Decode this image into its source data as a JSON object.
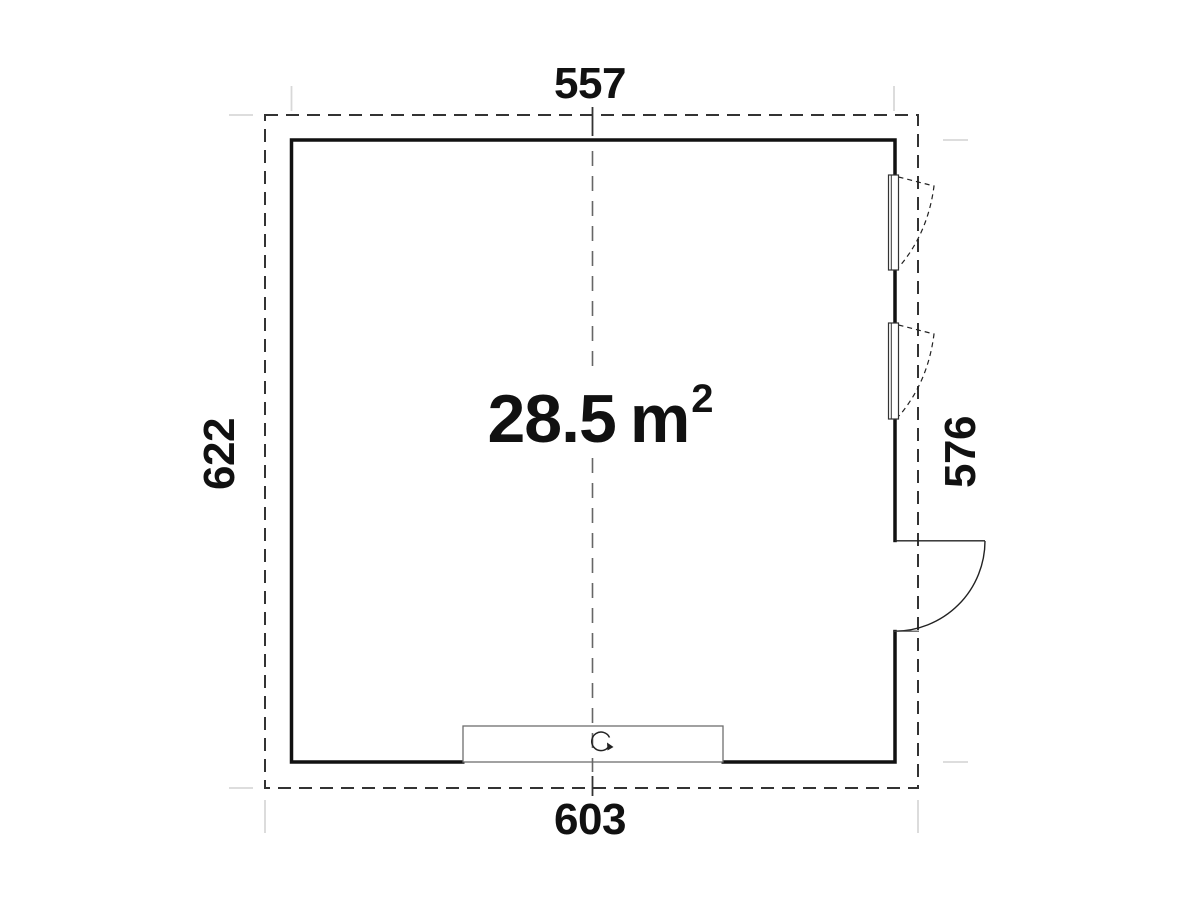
{
  "plan": {
    "dimensions": {
      "top": "557",
      "bottom": "603",
      "left": "622",
      "right": "576"
    },
    "area": {
      "value": "28.5",
      "unit": "m",
      "exponent": "2"
    },
    "icons": {
      "rotation_symbol": "rotation-arrow-icon"
    },
    "colors": {
      "background": "#ffffff",
      "wall": "#111111",
      "overhang_dash": "#333333",
      "centerline": "#666666",
      "detail_line": "#222222",
      "garage_outline": "#6e6e6e",
      "extension_line": "#d8d8d8",
      "text": "#111111"
    }
  }
}
